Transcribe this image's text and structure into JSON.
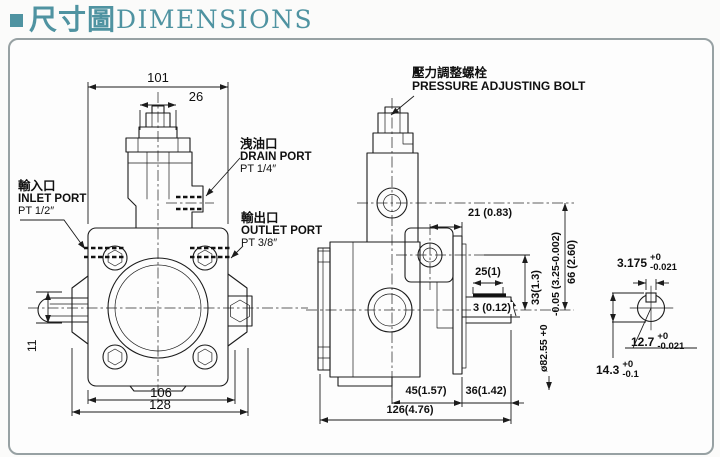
{
  "title": {
    "cjk": "尺寸圖",
    "en": "DIMENSIONS"
  },
  "colors": {
    "accent": "#4f93a1",
    "line": "#1c1c1c"
  },
  "front_view": {
    "dims": {
      "width_top": "101",
      "width_nut": "26",
      "width_bolt": "106",
      "width_total": "128",
      "shaft_key": "11"
    },
    "ports": {
      "drain": {
        "cjk": "洩油口",
        "en": "DRAIN PORT",
        "thread": "PT 1/4″"
      },
      "inlet": {
        "cjk": "輸入口",
        "en": "INLET PORT",
        "thread": "PT 1/2″"
      },
      "outlet": {
        "cjk": "輸出口",
        "en": "OUTLET PORT",
        "thread": "PT 3/8″"
      }
    }
  },
  "side_view": {
    "bolt_label": {
      "cjk": "壓力調整螺栓",
      "en": "PRESSURE ADJUSTING BOLT"
    },
    "dims": {
      "d21": "21 (0.83)",
      "d25": "25(1)",
      "d3": "3 (0.12)",
      "d33": "33(1.3)",
      "d66": "66 (2.60)",
      "shaft_dia_line1": "ø82.55 +0",
      "shaft_dia_line2": "-0.05 (3.25-0.002)",
      "d45": "45(1.57)",
      "d36": "36(1.42)",
      "d126": "126(4.76)"
    }
  },
  "shaft_detail": {
    "key_width": {
      "value": "3.175",
      "tol_upper": "+0",
      "tol_lower": "-0.021"
    },
    "shaft_dia": {
      "value": "12.7",
      "tol_upper": "+0",
      "tol_lower": "-0.021"
    },
    "total_height": {
      "value": "14.3",
      "tol_upper": "+0",
      "tol_lower": "-0.1"
    }
  }
}
